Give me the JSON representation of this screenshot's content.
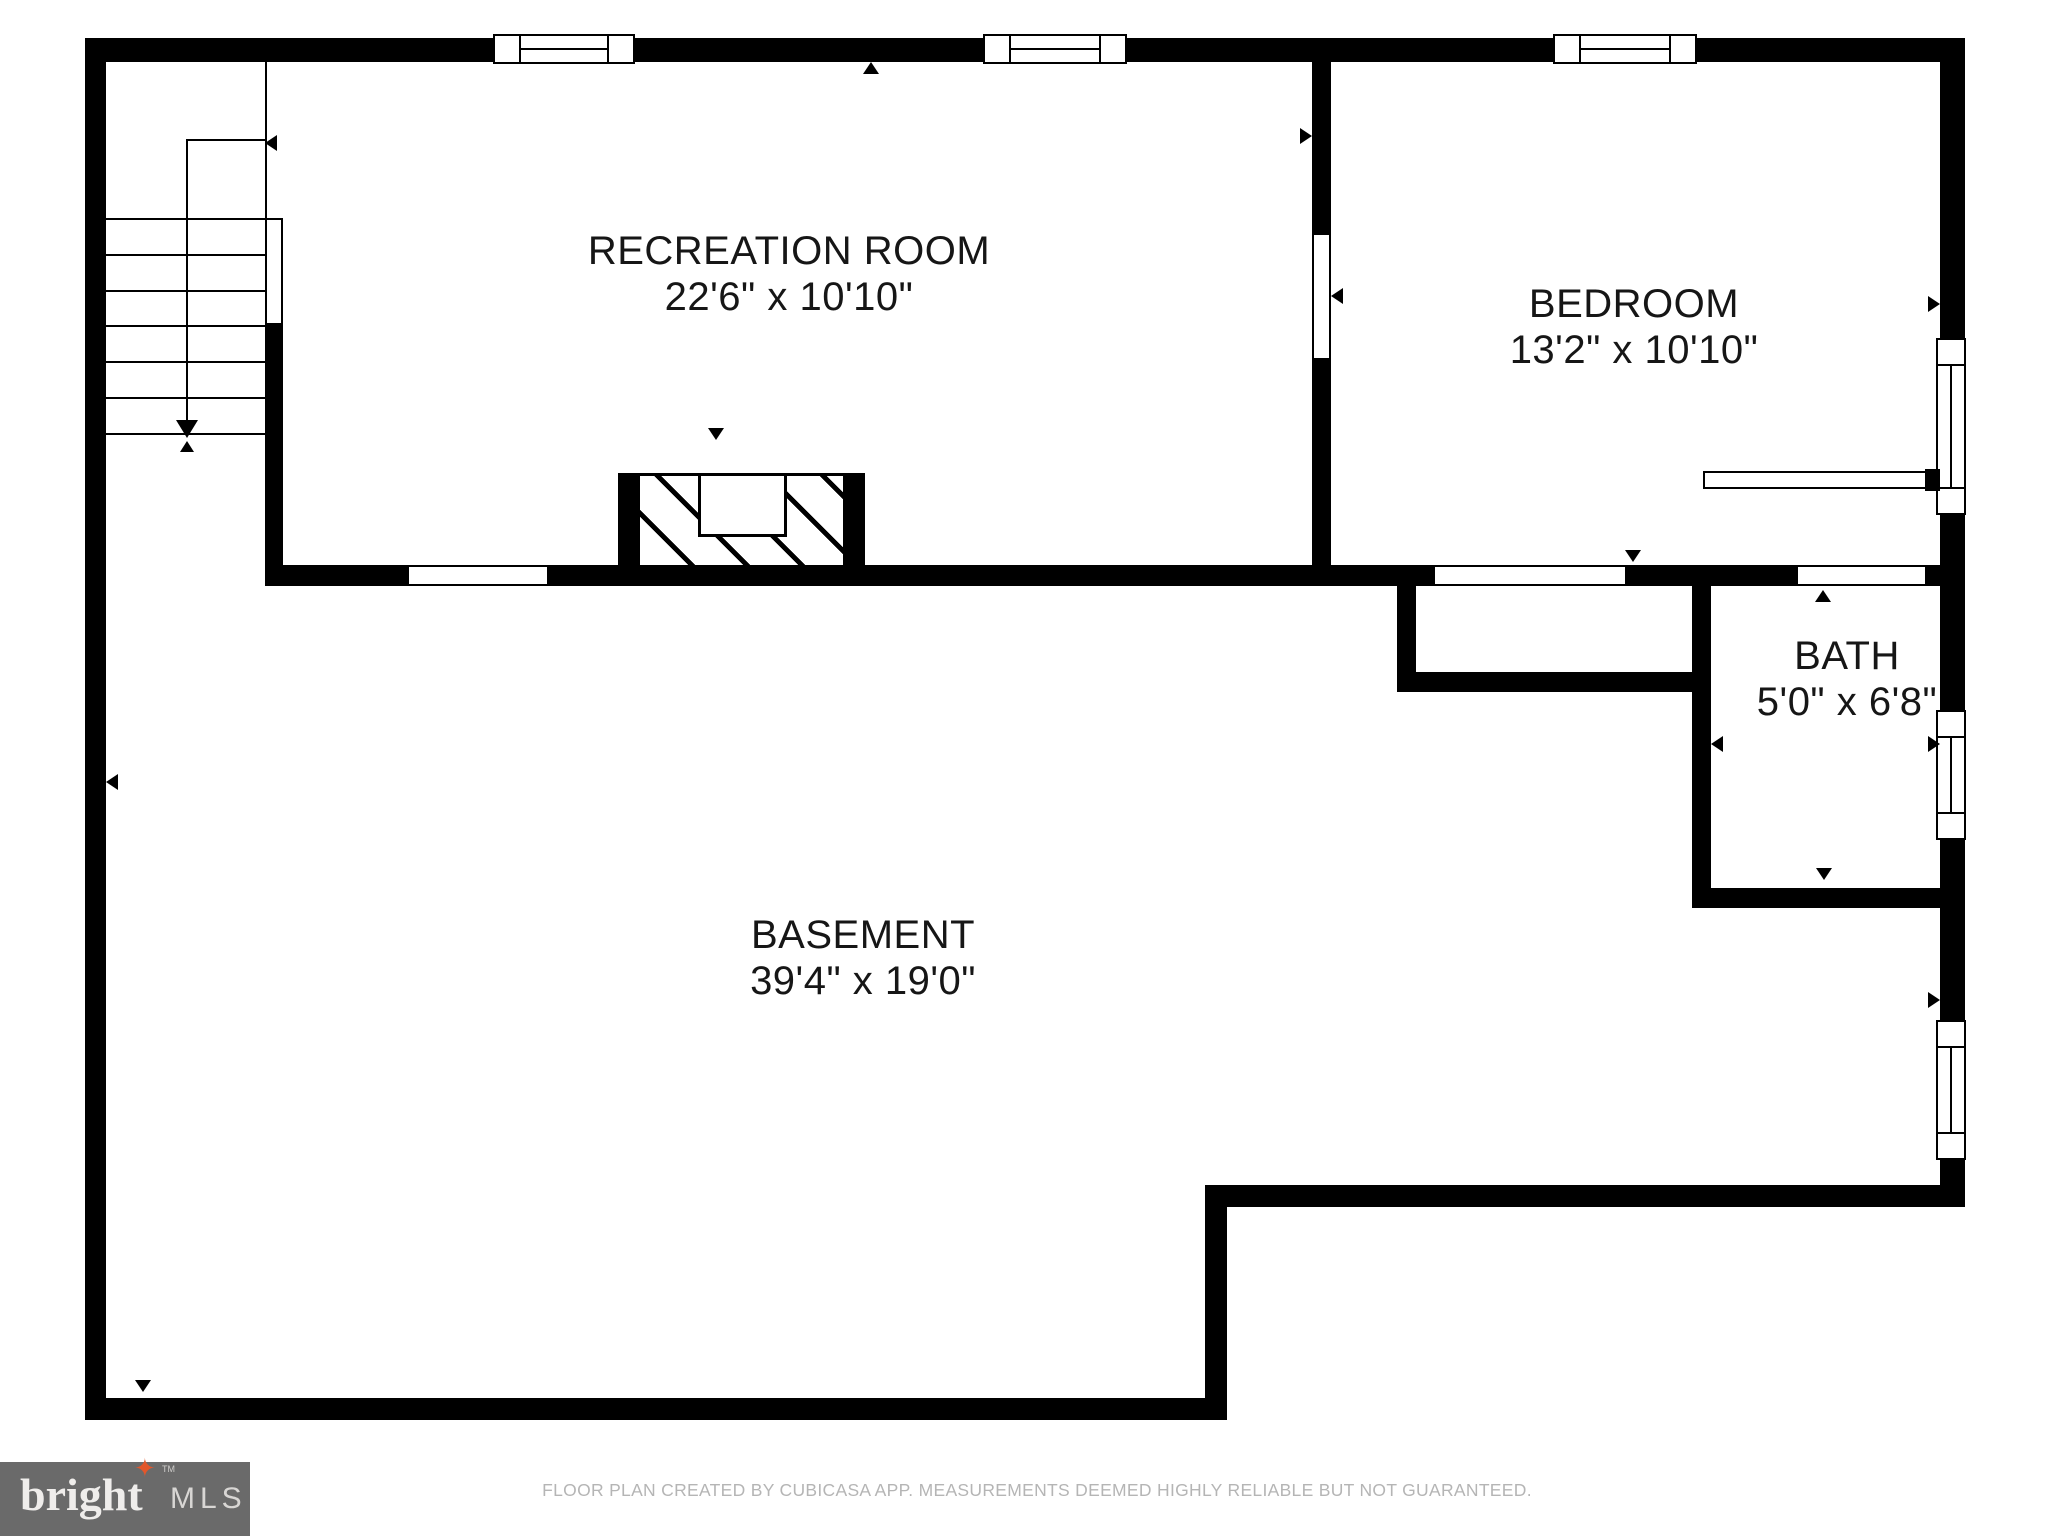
{
  "rooms": [
    {
      "name": "RECREATION ROOM",
      "dims": "22'6\" x 10'10\""
    },
    {
      "name": "BEDROOM",
      "dims": "13'2\" x 10'10\""
    },
    {
      "name": "BATH",
      "dims": "5'0\" x 6'8\""
    },
    {
      "name": "BASEMENT",
      "dims": "39'4\" x 19'0\""
    }
  ],
  "logo": {
    "brand": "bright",
    "suffix": "MLS",
    "tm": "TM",
    "star": "✦",
    "star_color": "#e2572b",
    "bg_color": "#6a6a6a"
  },
  "footer": {
    "disclaimer": "FLOOR PLAN CREATED BY CUBICASA APP. MEASUREMENTS DEEMED HIGHLY RELIABLE BUT NOT GUARANTEED."
  },
  "colors": {
    "wall": "#000000",
    "background": "#ffffff",
    "label_text": "#161616",
    "disclaimer_text": "#b5b5b5"
  }
}
